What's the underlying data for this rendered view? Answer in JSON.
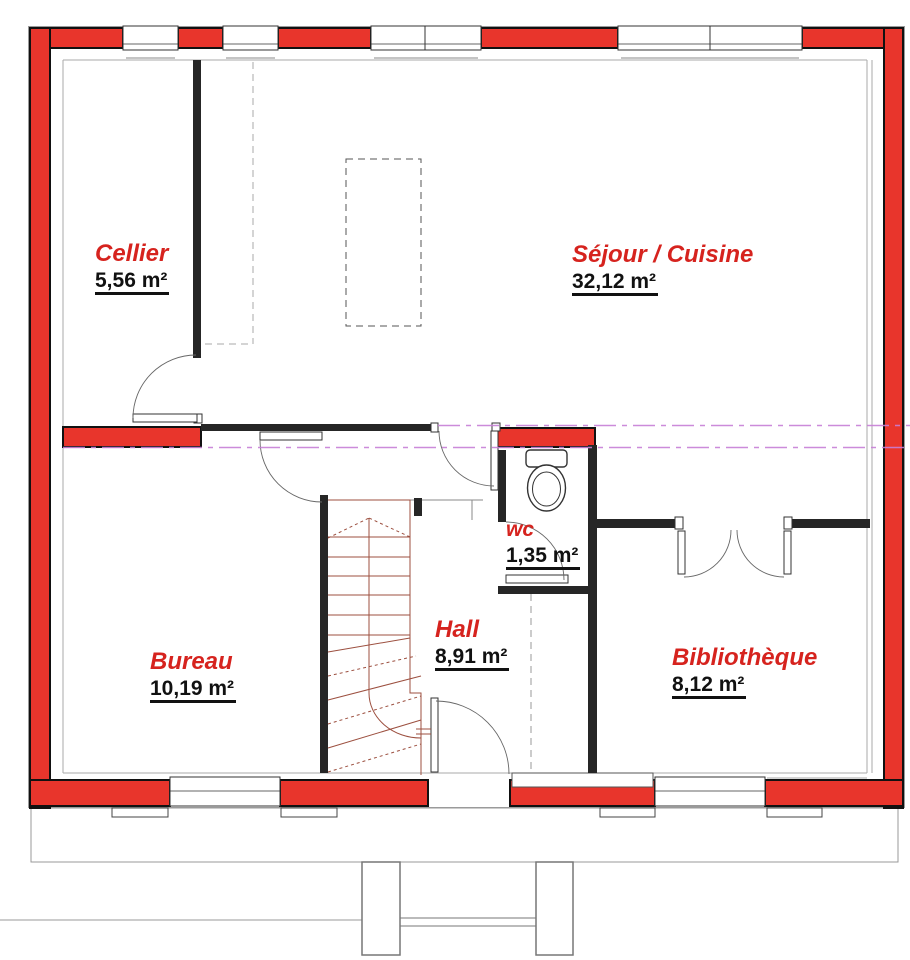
{
  "plan": {
    "title": "Floor plan (rez-de-chaussée)",
    "rooms": [
      {
        "id": "cellier",
        "name": "Cellier",
        "area": "5,56 m²"
      },
      {
        "id": "sejour-cuisine",
        "name": "Séjour / Cuisine",
        "area": "32,12 m²"
      },
      {
        "id": "wc",
        "name": "wc",
        "area": "1,35 m²"
      },
      {
        "id": "hall",
        "name": "Hall",
        "area": "8,91 m²"
      },
      {
        "id": "bureau",
        "name": "Bureau",
        "area": "10,19 m²"
      },
      {
        "id": "bibliotheque",
        "name": "Bibliothèque",
        "area": "8,12 m²"
      }
    ],
    "colors": {
      "exterior_wall": "#e8352c",
      "interior_wall": "#262626",
      "room_name_text": "#d6231e",
      "area_text": "#111111",
      "section_line": "#c77fd6",
      "stair_line": "#9c4f3f"
    }
  }
}
